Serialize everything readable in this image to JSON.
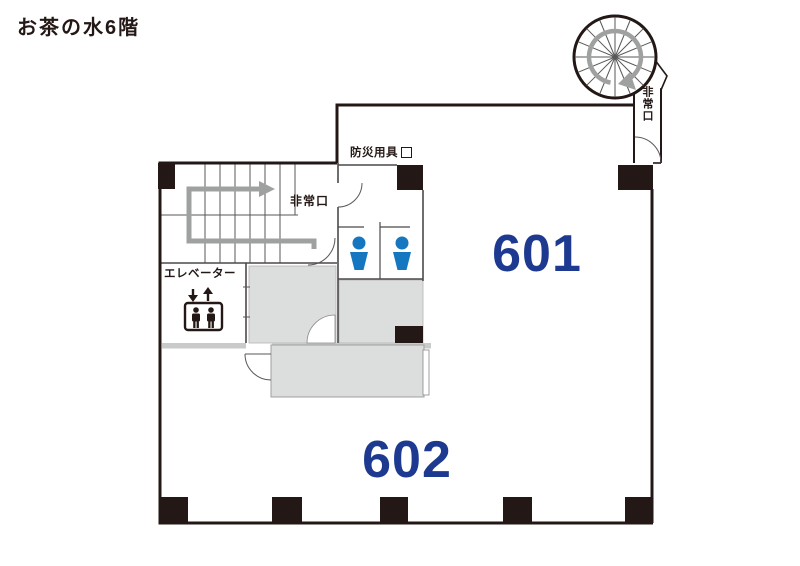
{
  "page": {
    "title": "お茶の水6階"
  },
  "floor_plan": {
    "room_numbers": [
      {
        "id": "601",
        "label": "601"
      },
      {
        "id": "602",
        "label": "602"
      }
    ],
    "labels": {
      "disaster_equipment": "防災用具",
      "emergency_exit_stairs": "非常口",
      "emergency_exit_spiral": "非常口",
      "elevator": "エレベーター"
    },
    "colors": {
      "wall": "#231815",
      "room_number_text": "#1d3a90",
      "toilet_icon_blue": "#1577c0",
      "gray_zone_fill": "#dcdddd",
      "gray_wall_band": "#c9caca",
      "route_arrow_gray": "#9fa0a0"
    }
  }
}
